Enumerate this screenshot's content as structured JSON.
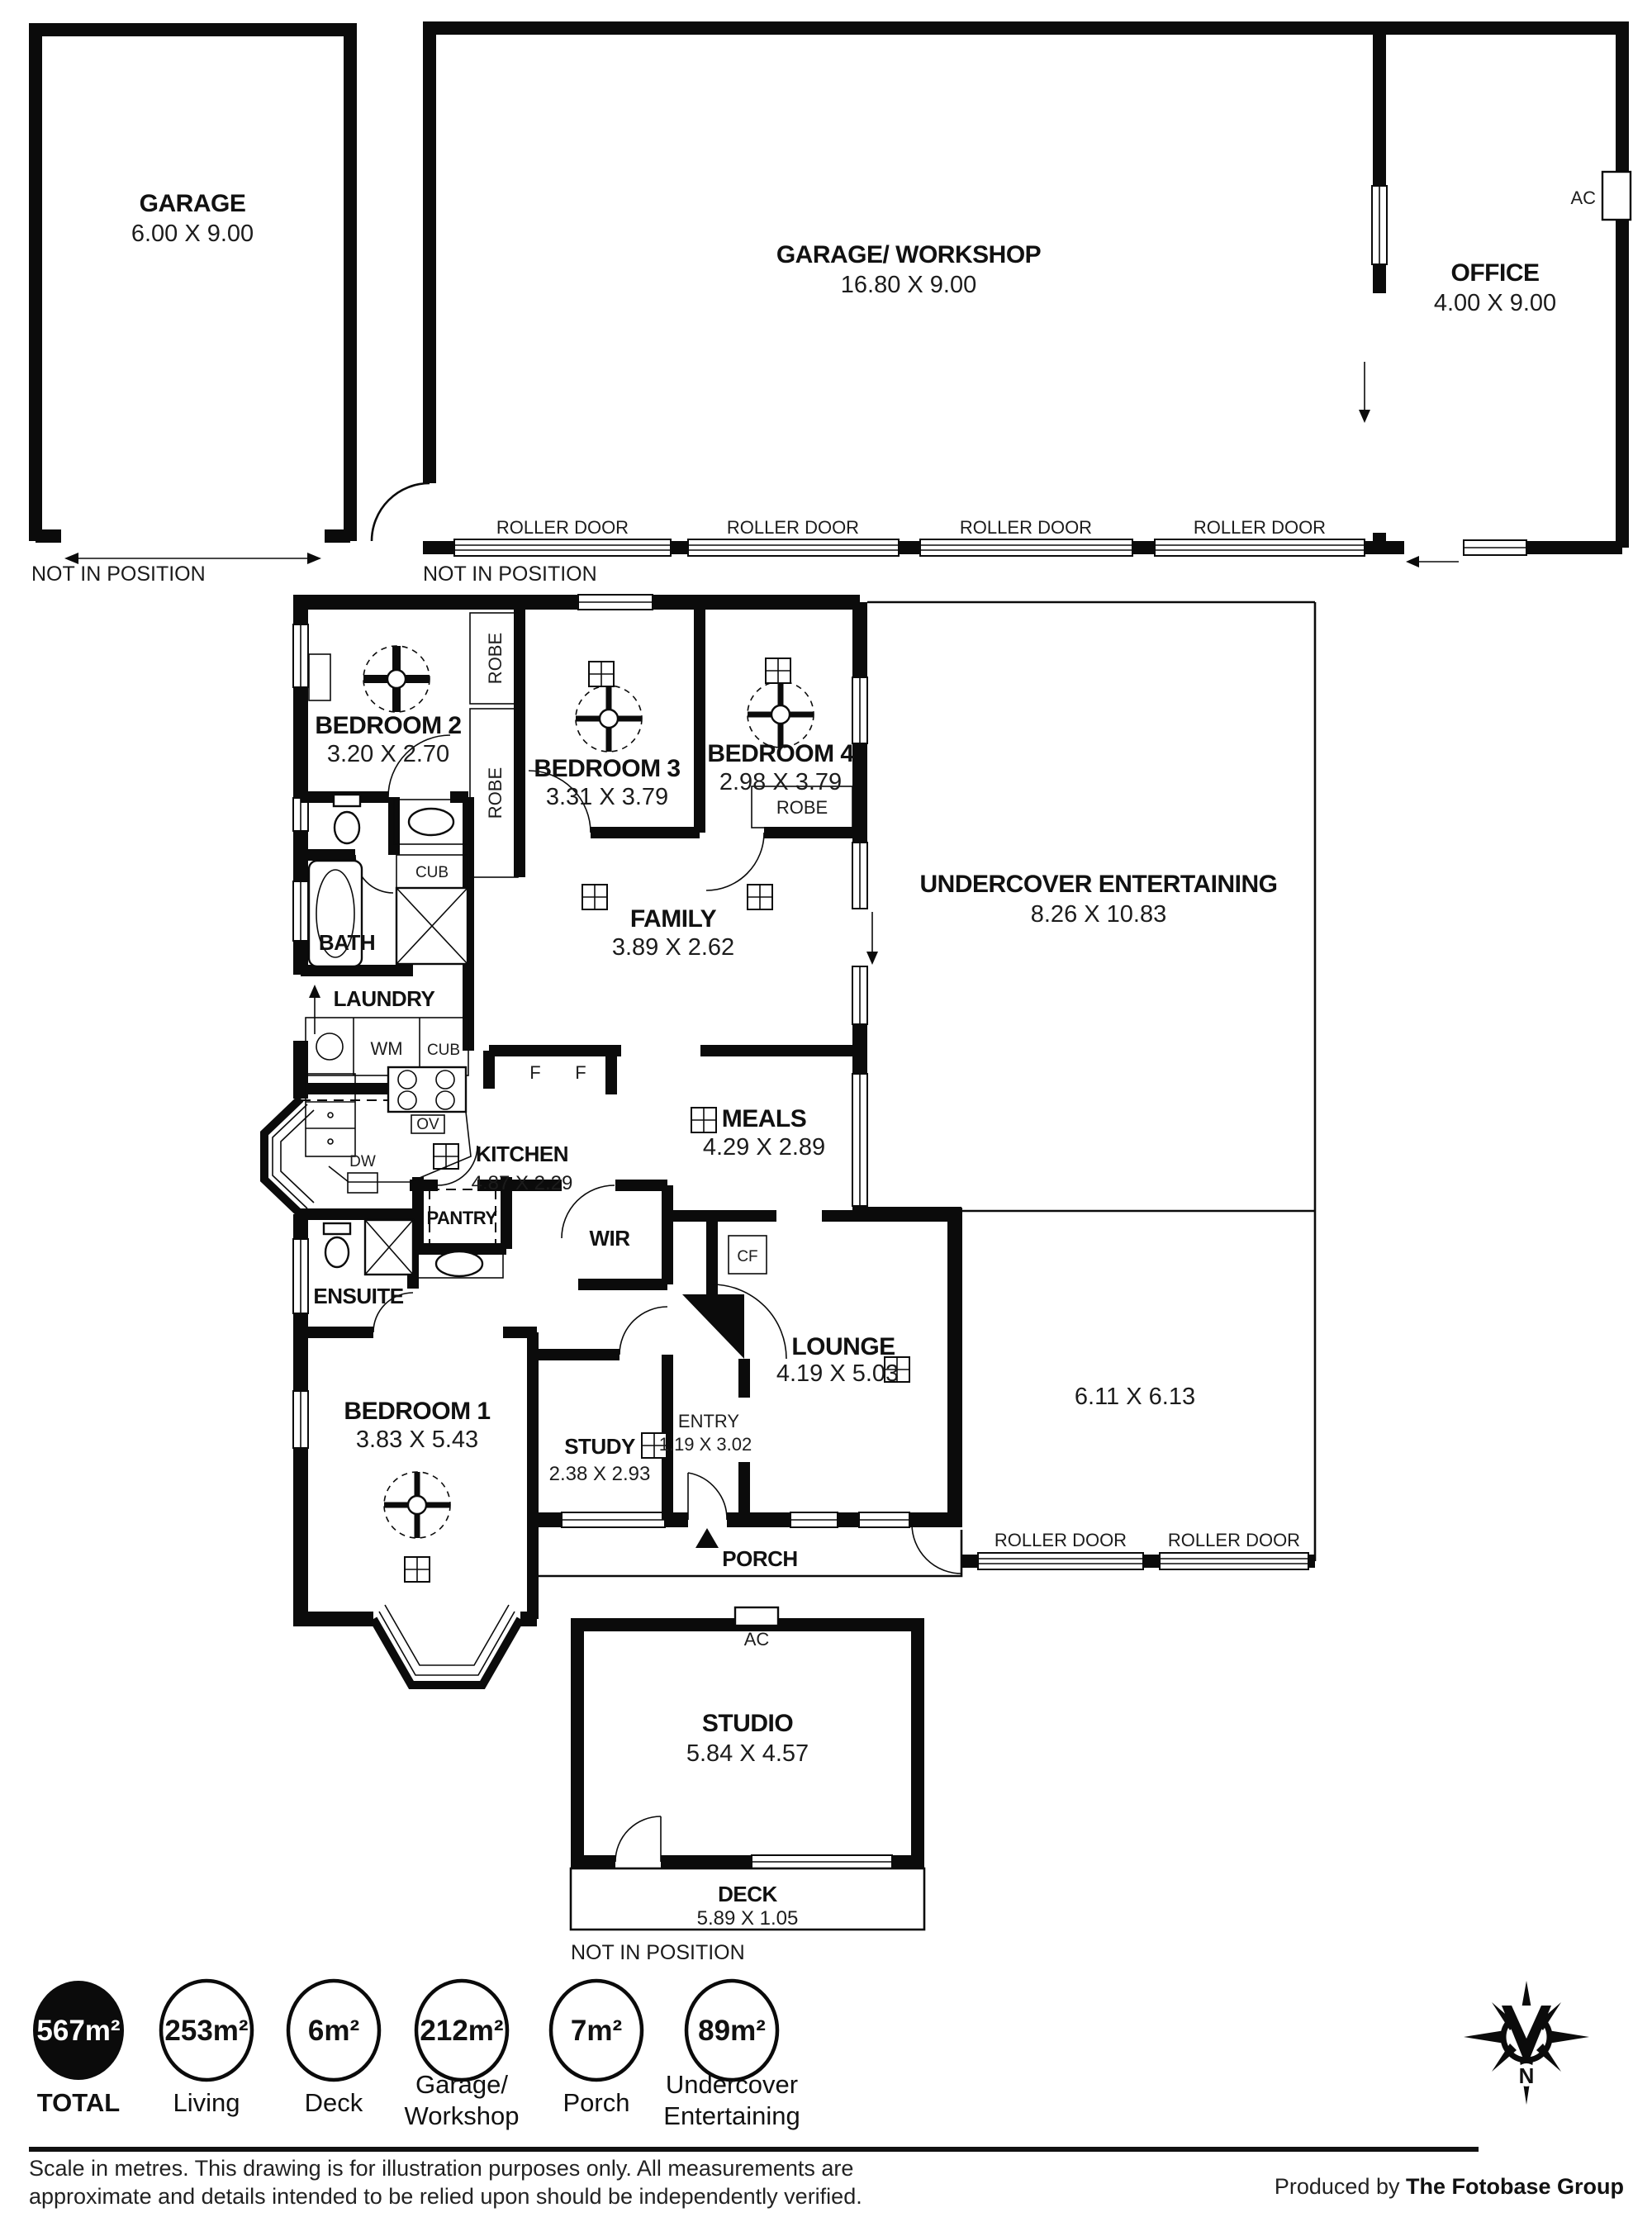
{
  "plan": {
    "garage": {
      "name": "GARAGE",
      "dims": "6.00 X 9.00"
    },
    "workshop": {
      "name": "GARAGE/ WORKSHOP",
      "dims": "16.80 X 9.00"
    },
    "office": {
      "name": "OFFICE",
      "dims": "4.00 X 9.00"
    },
    "undercover": {
      "name": "UNDERCOVER ENTERTAINING",
      "dims": "8.26 X 10.83"
    },
    "bedroom2": {
      "name": "BEDROOM 2",
      "dims": "3.20 X 2.70"
    },
    "bedroom3": {
      "name": "BEDROOM 3",
      "dims": "3.31 X 3.79"
    },
    "bedroom4": {
      "name": "BEDROOM 4",
      "dims": "2.98 X 3.79"
    },
    "family": {
      "name": "FAMILY",
      "dims": "3.89 X 2.62"
    },
    "meals": {
      "name": "MEALS",
      "dims": "4.29 X 2.89"
    },
    "kitchen": {
      "name": "KITCHEN",
      "dims": "4.87 X 2.29"
    },
    "bath": {
      "name": "BATH"
    },
    "laundry": {
      "name": "LAUNDRY"
    },
    "pantry": {
      "name": "PANTRY"
    },
    "wir": {
      "name": "WIR"
    },
    "ensuite": {
      "name": "ENSUITE"
    },
    "bedroom1": {
      "name": "BEDROOM 1",
      "dims": "3.83 X 5.43"
    },
    "study": {
      "name": "STUDY",
      "dims": "2.38 X 2.93"
    },
    "entry": {
      "name": "ENTRY",
      "dims": "1.19 X 3.02"
    },
    "lounge": {
      "name": "LOUNGE",
      "dims": "4.19 X 5.03"
    },
    "garage_rear": {
      "dims": "6.11 X 6.13"
    },
    "porch": {
      "name": "PORCH"
    },
    "studio": {
      "name": "STUDIO",
      "dims": "5.84 X 4.57"
    },
    "deck": {
      "name": "DECK",
      "dims": "5.89 X 1.05"
    }
  },
  "ann": {
    "roller_door": "ROLLER DOOR",
    "not_in_position": "NOT IN POSITION",
    "robe": "ROBE",
    "cub": "CUB",
    "wm": "WM",
    "ov": "OV",
    "dw": "DW",
    "fridge": "F",
    "cf": "CF",
    "ac": "AC",
    "north": "N"
  },
  "legend": {
    "items": [
      {
        "value": "567m²",
        "label": "TOTAL",
        "filled": true
      },
      {
        "value": "253m²",
        "label": "Living",
        "filled": false
      },
      {
        "value": "6m²",
        "label": "Deck",
        "filled": false
      },
      {
        "value": "212m²",
        "label": "Garage/",
        "label2": "Workshop",
        "filled": false
      },
      {
        "value": "7m²",
        "label": "Porch",
        "filled": false
      },
      {
        "value": "89m²",
        "label": "Undercover",
        "label2": "Entertaining",
        "filled": false
      }
    ]
  },
  "footer": {
    "disclaimer1": "Scale in metres. This drawing is for illustration purposes only. All measurements are",
    "disclaimer2": "approximate and details intended to be relied upon should be independently verified.",
    "produced_by": "Produced by ",
    "producer": "The Fotobase Group"
  }
}
